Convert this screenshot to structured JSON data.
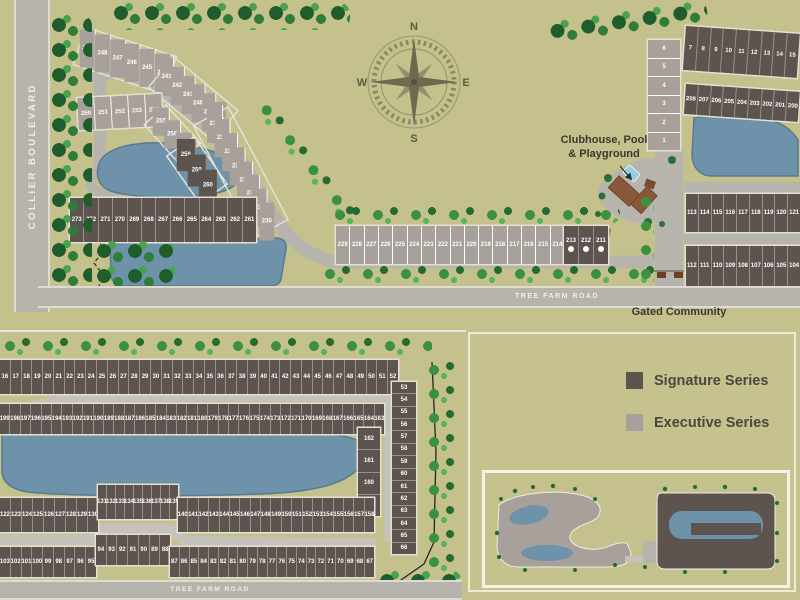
{
  "colors": {
    "background": "#c4c18c",
    "executive_lot": "#a8a09a",
    "signature_lot": "#5d5450",
    "water": "#6d92aa",
    "road": "#b7b4ae",
    "tree": "#1f5e2c",
    "palm": "#3c9140",
    "label_text": "#39382e",
    "lot_number_text": "#ffffff"
  },
  "compass": {
    "north": "N",
    "east": "E",
    "south": "S",
    "west": "W"
  },
  "labels": {
    "collier_boulevard": "COLLIER BOULEVARD",
    "tree_farm_road_top": "TREE FARM ROAD",
    "tree_farm_road_bottom": "TREE FARM ROAD",
    "clubhouse_line1": "Clubhouse, Pool",
    "clubhouse_line2": "& Playground",
    "gated_community": "Gated Community"
  },
  "legend": {
    "items": [
      {
        "label": "Signature Series"
      },
      {
        "label": "Executive Series"
      }
    ]
  },
  "main_plan": {
    "lot_rows": {
      "arc_a": [
        249,
        248,
        247,
        246,
        245,
        244
      ],
      "arc_b": [
        243,
        242,
        241,
        240,
        239,
        238
      ],
      "arc_c": [
        237,
        236,
        235,
        234,
        233,
        232,
        231,
        230
      ],
      "cluster_250s": [
        250,
        251,
        252,
        253,
        254
      ],
      "curve_255s": [
        255,
        256,
        257
      ],
      "sig_arc": [
        258,
        259,
        260
      ],
      "sig_row": [
        273,
        272,
        271,
        270,
        269,
        268,
        267,
        266,
        265,
        264,
        263,
        262,
        261
      ],
      "long_row": [
        229,
        228,
        227,
        226,
        225,
        224,
        223,
        222,
        221,
        220,
        219,
        218,
        217,
        216,
        215,
        214
      ],
      "long_row_end": [
        213,
        212,
        211
      ],
      "ne_col": [
        6,
        5,
        4,
        3,
        2,
        1
      ],
      "ne_top": [
        7,
        8,
        9,
        10,
        11,
        12,
        13,
        14,
        15
      ],
      "ne_row2": [
        208,
        207,
        206,
        205,
        204,
        203,
        202,
        201,
        200
      ],
      "ne_row3": [
        113,
        114,
        115,
        116,
        117,
        118,
        119,
        120,
        121
      ],
      "ne_row4": [
        112,
        111,
        110,
        109,
        108,
        107,
        106,
        105,
        104
      ]
    }
  },
  "detail_plan": {
    "lot_rows": {
      "row1": [
        16,
        17,
        18,
        19,
        20,
        21,
        22,
        23,
        24,
        25,
        26,
        27,
        28,
        29,
        30,
        31,
        32,
        33,
        34,
        35,
        36,
        37,
        38,
        39,
        40,
        41,
        42,
        43,
        44,
        45,
        46,
        47,
        48,
        49,
        50,
        51,
        52
      ],
      "right_col": [
        53,
        54,
        55,
        56,
        57,
        58,
        59,
        60,
        61,
        62,
        63,
        64,
        65,
        66
      ],
      "row2": [
        199,
        198,
        197,
        196,
        195,
        194,
        193,
        192,
        191,
        190,
        189,
        188,
        187,
        186,
        185,
        184,
        183,
        182,
        181,
        180,
        179,
        178,
        177,
        176,
        175,
        174,
        173,
        172,
        171,
        170,
        169,
        168,
        167,
        166,
        165,
        164,
        163
      ],
      "inner_col": [
        162,
        161,
        160,
        159
      ],
      "row3_a": [
        122,
        123,
        124,
        125,
        126,
        127,
        128,
        129,
        130
      ],
      "row3_b": [
        131,
        132,
        133,
        134,
        135,
        136,
        137,
        138,
        139
      ],
      "row3_c": [
        140,
        141,
        142,
        143,
        144,
        145,
        146,
        147,
        148,
        149,
        150,
        151,
        152,
        153,
        154,
        155,
        156,
        157,
        158
      ],
      "bottom_a": [
        103,
        102,
        101,
        100,
        99,
        98,
        97,
        96,
        95
      ],
      "bottom_b": [
        94,
        93,
        92,
        91,
        90,
        89,
        88
      ],
      "bottom_c": [
        87,
        86,
        85,
        84,
        83,
        82,
        81,
        80,
        79,
        78,
        77,
        76,
        75,
        74,
        73,
        72,
        71,
        70,
        69,
        68,
        67
      ]
    }
  }
}
